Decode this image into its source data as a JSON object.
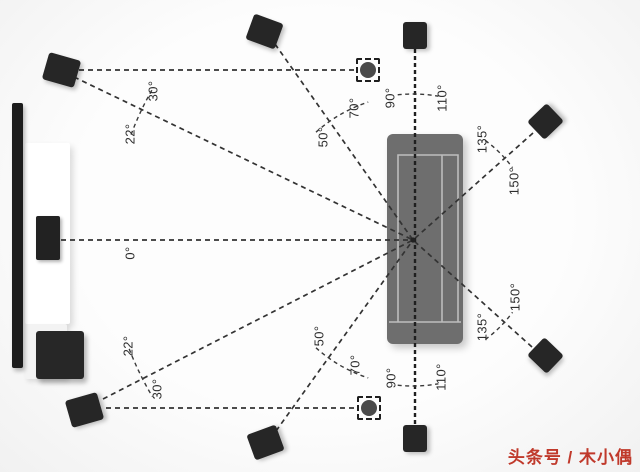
{
  "diagram_title": "surround-speaker-placement-top-view",
  "listening_point": {
    "x": 413,
    "y": 240
  },
  "furniture": [
    {
      "name": "tv",
      "cls": "tv",
      "x": 12,
      "y": 103,
      "w": 11,
      "h": 265
    },
    {
      "name": "media-cabinet",
      "cls": "cabinet",
      "x": 25,
      "y": 143,
      "w": 45,
      "h": 181
    },
    {
      "name": "cabinet-shelf",
      "cls": "shelf",
      "x": 25,
      "y": 324,
      "w": 42,
      "h": 55
    },
    {
      "name": "center-speaker",
      "cls": "cspeaker",
      "x": 36,
      "y": 216,
      "w": 24,
      "h": 44
    },
    {
      "name": "subwoofer",
      "cls": "sub",
      "x": 36,
      "y": 331,
      "w": 48,
      "h": 48
    },
    {
      "name": "sofa",
      "cls": "sofa",
      "x": 387,
      "y": 134,
      "w": 76,
      "h": 210
    }
  ],
  "sofa_inner_paths": [
    "M398,322 L398,155 L458,155 L458,322",
    "M442,155 L442,322",
    "M389,322 L461,322"
  ],
  "speakers": [
    {
      "name": "speaker-front-upper",
      "cx": 61,
      "cy": 70,
      "w": 33,
      "h": 28,
      "rot": 16
    },
    {
      "name": "speaker-wide-upper",
      "cx": 264,
      "cy": 31,
      "w": 31,
      "h": 27,
      "rot": 20
    },
    {
      "name": "speaker-top-upper",
      "cx": 415,
      "cy": 35,
      "w": 24,
      "h": 27,
      "rot": 0
    },
    {
      "name": "speaker-rear-upper",
      "cx": 545,
      "cy": 121,
      "w": 27,
      "h": 25,
      "rot": -44
    },
    {
      "name": "speaker-rear-lower",
      "cx": 545,
      "cy": 355,
      "w": 27,
      "h": 25,
      "rot": 44
    },
    {
      "name": "speaker-top-lower",
      "cx": 415,
      "cy": 438,
      "w": 24,
      "h": 27,
      "rot": 0
    },
    {
      "name": "speaker-wide-lower",
      "cx": 265,
      "cy": 442,
      "w": 31,
      "h": 27,
      "rot": -20
    },
    {
      "name": "speaker-front-lower",
      "cx": 84,
      "cy": 410,
      "w": 33,
      "h": 28,
      "rot": -16
    }
  ],
  "overhead_markers": [
    {
      "name": "overhead-speaker-upper",
      "cx": 368,
      "cy": 70,
      "size": 24
    },
    {
      "name": "overhead-speaker-lower",
      "cx": 369,
      "cy": 408,
      "size": 24
    }
  ],
  "lines": [
    {
      "x1": 74,
      "y1": 77,
      "x2": 413,
      "y2": 240
    },
    {
      "x1": 275,
      "y1": 44,
      "x2": 413,
      "y2": 240
    },
    {
      "x1": 533,
      "y1": 133,
      "x2": 413,
      "y2": 240
    },
    {
      "x1": 61,
      "y1": 240,
      "x2": 413,
      "y2": 240
    },
    {
      "x1": 103,
      "y1": 399,
      "x2": 413,
      "y2": 240
    },
    {
      "x1": 276,
      "y1": 431,
      "x2": 413,
      "y2": 240
    },
    {
      "x1": 532,
      "y1": 347,
      "x2": 413,
      "y2": 240
    },
    {
      "x1": 79,
      "y1": 70,
      "x2": 356,
      "y2": 70
    },
    {
      "x1": 106,
      "y1": 408,
      "x2": 357,
      "y2": 408
    },
    {
      "x1": 415,
      "y1": 49,
      "x2": 415,
      "y2": 424,
      "main": true
    }
  ],
  "arcs": [
    {
      "r": 301,
      "a1": 20.5,
      "a2": 30.5
    },
    {
      "r": 145,
      "a1": 48,
      "a2": 72
    },
    {
      "r": 146,
      "a1": 84,
      "a2": 100
    },
    {
      "r": 123,
      "a1": 126,
      "a2": 144
    },
    {
      "r": 304,
      "a1": -21,
      "a2": -31
    },
    {
      "r": 145,
      "a1": -48,
      "a2": -72
    },
    {
      "r": 146,
      "a1": -84,
      "a2": -100
    },
    {
      "r": 123,
      "a1": -126,
      "a2": -144
    }
  ],
  "angle_labels": [
    {
      "name": "label-0",
      "text": "0°",
      "x": 130,
      "y": 253
    },
    {
      "name": "label-22-upper",
      "text": "22°",
      "x": 130,
      "y": 134
    },
    {
      "name": "label-30-upper",
      "text": "30°",
      "x": 153,
      "y": 91
    },
    {
      "name": "label-50-upper",
      "text": "50°",
      "x": 323,
      "y": 137
    },
    {
      "name": "label-70-upper",
      "text": "70°",
      "x": 354,
      "y": 108
    },
    {
      "name": "label-90-upper",
      "text": "90°",
      "x": 390,
      "y": 98
    },
    {
      "name": "label-110-upper",
      "text": "110°",
      "x": 442,
      "y": 98
    },
    {
      "name": "label-135-upper",
      "text": "135°",
      "x": 482,
      "y": 139
    },
    {
      "name": "label-150-upper",
      "text": "150°",
      "x": 514,
      "y": 181
    },
    {
      "name": "label-22-lower",
      "text": "22°",
      "x": 128,
      "y": 346
    },
    {
      "name": "label-30-lower",
      "text": "30°",
      "x": 157,
      "y": 389
    },
    {
      "name": "label-50-lower",
      "text": "50°",
      "x": 319,
      "y": 336
    },
    {
      "name": "label-70-lower",
      "text": "70°",
      "x": 355,
      "y": 365
    },
    {
      "name": "label-90-lower",
      "text": "90°",
      "x": 391,
      "y": 378
    },
    {
      "name": "label-110-lower",
      "text": "110°",
      "x": 441,
      "y": 377
    },
    {
      "name": "label-135-lower",
      "text": "135°",
      "x": 482,
      "y": 327
    },
    {
      "name": "label-150-lower",
      "text": "150°",
      "x": 515,
      "y": 297
    }
  ],
  "colors": {
    "line": "#333333",
    "main_line": "#1f1f1f",
    "arc": "#3a3a3a",
    "sofa_inner": "#bdbdbd",
    "watermark": "#c0392b"
  },
  "watermark": {
    "text": "头条号 / 木小偶"
  }
}
